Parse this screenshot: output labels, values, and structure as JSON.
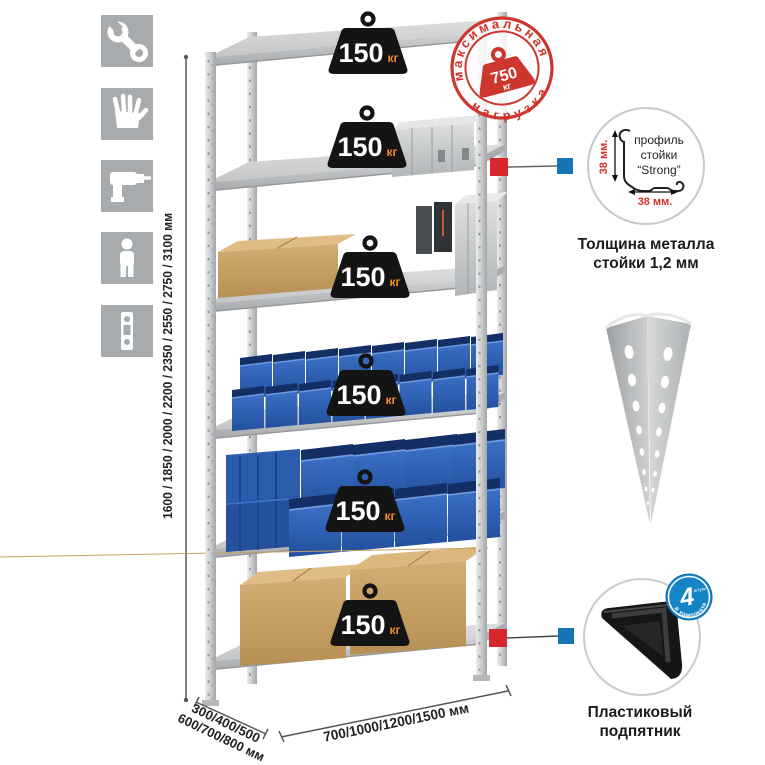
{
  "stamp": {
    "arc_top": "максимальная",
    "arc_bottom": "нагрузка",
    "weight_value": "750",
    "weight_unit": "кг",
    "color": "#cd362d"
  },
  "shelf_badge": {
    "value": "150",
    "unit": "кг",
    "count": 6,
    "bg_color": "#141414",
    "unit_color": "#f08a2a"
  },
  "dimensions": {
    "height_label": "1600 / 1850 / 2000 / 2200 / 2350 / 2550 / 2750 / 3100 мм",
    "depth_label_line1": "300/400/500",
    "depth_label_line2": "600/700/800 мм",
    "width_label": "700/1000/1200/1500 мм"
  },
  "profile_callout": {
    "title_line1": "профиль",
    "title_line2": "стойки",
    "title_line3": "“Strong”",
    "vertical_dim": "38 мм.",
    "horizontal_dim": "38 мм.",
    "caption_line1": "Толщина металла",
    "caption_line2": "стойки 1,2 мм"
  },
  "foot_callout": {
    "quantity": "4",
    "quantity_note": "штуки",
    "arc_text": "в комплекте",
    "badge_color": "#1584c5",
    "caption_line1": "Пластиковый",
    "caption_line2": "подпятник"
  },
  "side_icons": [
    "wrench",
    "work-gloves",
    "drill",
    "person",
    "spirit-level"
  ],
  "colors": {
    "icon_square": "#a8abad",
    "callout_red": "#d8262c",
    "callout_blue": "#1575b5",
    "bin_blue": "#2e62b8",
    "metal_light": "#d6d8d9"
  }
}
